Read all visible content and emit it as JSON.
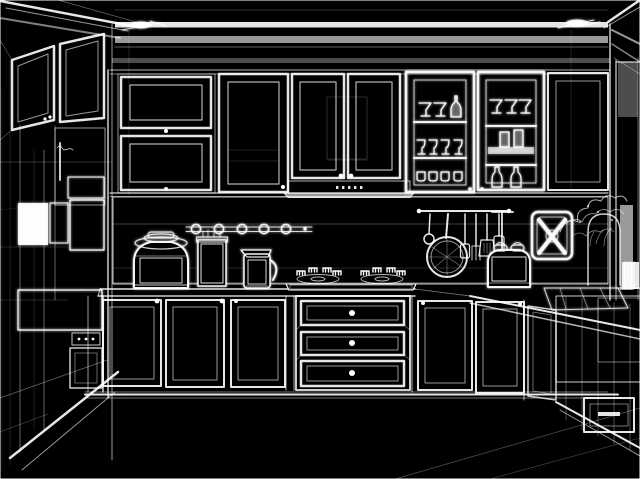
{
  "meta": {
    "description": "3D wireframe rendering of a modern kitchen interior, drawn as white outlines and hatching on a black background; no visible text in the image"
  },
  "colors": {
    "background": "#000000",
    "line": "#ffffff",
    "dim_line": "#999999"
  },
  "scene": {
    "objects": [
      "ceiling-crown-molding",
      "ceiling-sprinkler-left",
      "ceiling-sprinkler-right",
      "left-wall-upper-cabinets",
      "tall-appliance-column-with-ovens",
      "back-wall-upper-cabinets",
      "range-hood",
      "glass-display-cabinet-left",
      "glass-display-cabinet-right",
      "tiled-backsplash",
      "spice-rail-with-round-holders",
      "utensil-hanging-rail",
      "frying-pan",
      "rice-cooker",
      "utensil-canister",
      "kettle",
      "gas-cooktop",
      "toaster",
      "wall-mounted-folding-stool",
      "decorative-plant",
      "right-louvered-panel",
      "base-cabinet-doors",
      "three-drawer-stack",
      "countertop",
      "floor-perspective-lines",
      "wire-dish-rack",
      "arched-wall-niche",
      "right-side-shelving-unit"
    ]
  }
}
